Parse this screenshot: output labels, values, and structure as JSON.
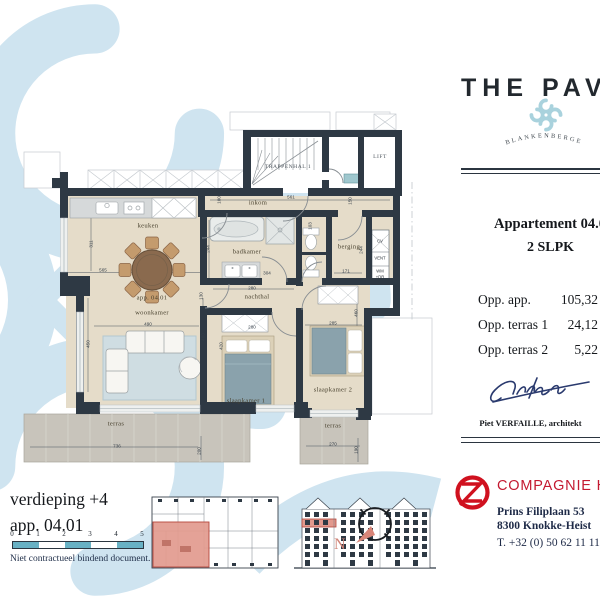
{
  "brand": {
    "title": "THE PAVILION",
    "subtitle": "BLANKENBERGE"
  },
  "apartment": {
    "heading": "Appartement 04.01",
    "type": "2 SLPK",
    "areas": [
      {
        "label": "Opp. app.",
        "value": "105,32"
      },
      {
        "label": "Opp. terras 1",
        "value": "24,12"
      },
      {
        "label": "Opp. terras 2",
        "value": "5,22"
      }
    ],
    "architect": "Piet VERFAILLE, architekt"
  },
  "company": {
    "name": "COMPAGNIE HET ZOUTE",
    "address_line1": "Prins Filiplaan 53",
    "address_line2": "8300 Knokke-Heist",
    "phone": "T. +32 (0) 50 62 11 11."
  },
  "floor_info": {
    "level": "verdieping +4",
    "apartment": "app. 04.01",
    "disclaimer": "Niet contractueel bindend document.",
    "scale_ticks": [
      "0",
      "1",
      "2",
      "3",
      "4",
      "5"
    ]
  },
  "compass": {
    "label": "N"
  },
  "colors": {
    "watermark_blue": "#cfe4f0",
    "wall_dark": "#2e3944",
    "floor_beige": "#e5dcc9",
    "terrace_grey": "#c8c4bb",
    "brand_red": "#c41a31",
    "highlight_salmon": "#e29a8e",
    "scalebar_blue": "#68b1c4"
  },
  "plan": {
    "labels": [
      {
        "t": "TRAPPENHAL 1",
        "x": 288,
        "y": 167,
        "c": "caps",
        "n": "room-label-trappenhal"
      },
      {
        "t": "LIFT",
        "x": 380,
        "y": 157,
        "c": "caps",
        "n": "room-label-lift"
      },
      {
        "t": "inkom",
        "x": 258,
        "y": 203,
        "c": "room",
        "n": "room-label-inkom"
      },
      {
        "t": "keuken",
        "x": 148,
        "y": 226,
        "c": "room",
        "n": "room-label-keuken"
      },
      {
        "t": "badkamer",
        "x": 247,
        "y": 252,
        "c": "room",
        "n": "room-label-badkamer"
      },
      {
        "t": "berging",
        "x": 349,
        "y": 247,
        "c": "room",
        "n": "room-label-berging"
      },
      {
        "t": "nachthal",
        "x": 257,
        "y": 297,
        "c": "room",
        "n": "room-label-nachthal"
      },
      {
        "t": "app. 04.01",
        "x": 152,
        "y": 298,
        "c": "room",
        "n": "room-label-app-number"
      },
      {
        "t": "woonkamer",
        "x": 152,
        "y": 313,
        "c": "room",
        "n": "room-label-woonkamer"
      },
      {
        "t": "slaapkamer 1",
        "x": 246,
        "y": 401,
        "c": "room",
        "n": "room-label-slaapkamer-1"
      },
      {
        "t": "slaapkamer 2",
        "x": 333,
        "y": 390,
        "c": "room",
        "n": "room-label-slaapkamer-2"
      },
      {
        "t": "terras",
        "x": 116,
        "y": 424,
        "c": "room",
        "n": "room-label-terras-1"
      },
      {
        "t": "terras",
        "x": 333,
        "y": 426,
        "c": "room",
        "n": "room-label-terras-2"
      },
      {
        "t": "CV",
        "x": 380,
        "y": 241,
        "c": "tech",
        "n": "tech-label-cv"
      },
      {
        "t": "VENT",
        "x": 380,
        "y": 258,
        "c": "tech",
        "n": "tech-label-vent"
      },
      {
        "t": "WM",
        "x": 380,
        "y": 271,
        "c": "tech",
        "n": "tech-label-wm"
      },
      {
        "t": "+DR",
        "x": 380,
        "y": 277,
        "c": "tech",
        "n": "tech-label-dr"
      },
      {
        "t": "565",
        "x": 103,
        "y": 270,
        "c": "dim",
        "n": "dim-label"
      },
      {
        "t": "311",
        "x": 91,
        "y": 244,
        "c": "dim",
        "r": -90,
        "n": "dim-label"
      },
      {
        "t": "490",
        "x": 148,
        "y": 324,
        "c": "dim",
        "n": "dim-label"
      },
      {
        "t": "450",
        "x": 88,
        "y": 344,
        "c": "dim",
        "r": -90,
        "n": "dim-label"
      },
      {
        "t": "400",
        "x": 203,
        "y": 337,
        "c": "dim",
        "r": -90,
        "n": "dim-label"
      },
      {
        "t": "561",
        "x": 291,
        "y": 197,
        "c": "dim",
        "n": "dim-label"
      },
      {
        "t": "100",
        "x": 219,
        "y": 200,
        "c": "dim",
        "r": -90,
        "n": "dim-label"
      },
      {
        "t": "150",
        "x": 350,
        "y": 201,
        "c": "dim",
        "r": -90,
        "n": "dim-label"
      },
      {
        "t": "244",
        "x": 208,
        "y": 249,
        "c": "dim",
        "r": -90,
        "n": "dim-label"
      },
      {
        "t": "103",
        "x": 310,
        "y": 226,
        "c": "dim",
        "r": -90,
        "n": "dim-label"
      },
      {
        "t": "304",
        "x": 267,
        "y": 273,
        "c": "dim",
        "n": "dim-label"
      },
      {
        "t": "280",
        "x": 252,
        "y": 288,
        "c": "dim",
        "n": "dim-label"
      },
      {
        "t": "130",
        "x": 201,
        "y": 296,
        "c": "dim",
        "r": -90,
        "n": "dim-label"
      },
      {
        "t": "280",
        "x": 252,
        "y": 327,
        "c": "dim",
        "n": "dim-label"
      },
      {
        "t": "420",
        "x": 221,
        "y": 346,
        "c": "dim",
        "r": -90,
        "n": "dim-label"
      },
      {
        "t": "171",
        "x": 346,
        "y": 271,
        "c": "dim",
        "n": "dim-label"
      },
      {
        "t": "244",
        "x": 361,
        "y": 250,
        "c": "dim",
        "r": -90,
        "n": "dim-label"
      },
      {
        "t": "285",
        "x": 333,
        "y": 323,
        "c": "dim",
        "n": "dim-label"
      },
      {
        "t": "460",
        "x": 356,
        "y": 313,
        "c": "dim",
        "r": -90,
        "n": "dim-label"
      },
      {
        "t": "736",
        "x": 117,
        "y": 446,
        "c": "dim",
        "n": "dim-label"
      },
      {
        "t": "200",
        "x": 199,
        "y": 451,
        "c": "dim",
        "r": -90,
        "n": "dim-label"
      },
      {
        "t": "270",
        "x": 333,
        "y": 444,
        "c": "dim",
        "n": "dim-label"
      },
      {
        "t": "190",
        "x": 356,
        "y": 450,
        "c": "dim",
        "r": -90,
        "n": "dim-label"
      }
    ]
  }
}
